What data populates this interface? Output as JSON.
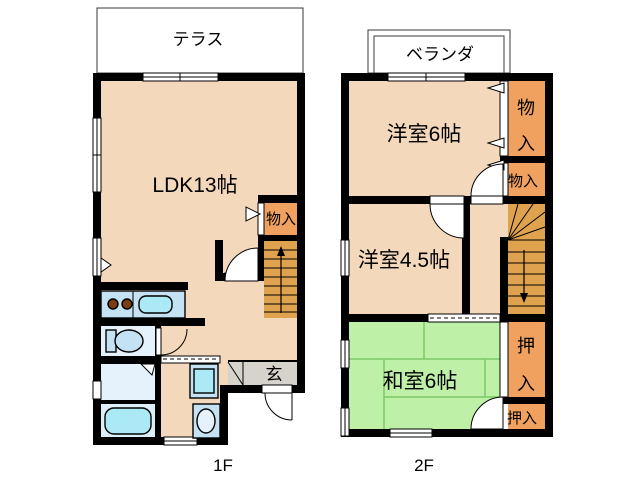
{
  "floors": {
    "f1": {
      "label": "1F",
      "terrace": "テラス",
      "ldk": "LDK13帖",
      "storage": "物入",
      "entrance": "玄"
    },
    "f2": {
      "label": "2F",
      "veranda": "ベランダ",
      "western6": "洋室6帖",
      "western45": "洋室4.5帖",
      "japanese6": "和室6帖",
      "storage": "物入",
      "storage_chars": [
        "物",
        "入"
      ],
      "closet": "押入",
      "closet_chars": [
        "押",
        "入"
      ]
    }
  },
  "colors": {
    "wall": "#000000",
    "floor": "#F3D8BC",
    "tatami": "#BFF0A8",
    "tatami_line": "#7DC868",
    "closet": "#F0A160",
    "stairs": "#DFA24F",
    "outdoor": "#D6D2CC",
    "wet_room": "#E5F2FB",
    "bath_room": "#DDEFF9",
    "fixture_blue": "#C4E2F3",
    "water_blue": "#ABE9F7",
    "burner_brown": "#7B3D12",
    "background": "#FFFFFF"
  }
}
